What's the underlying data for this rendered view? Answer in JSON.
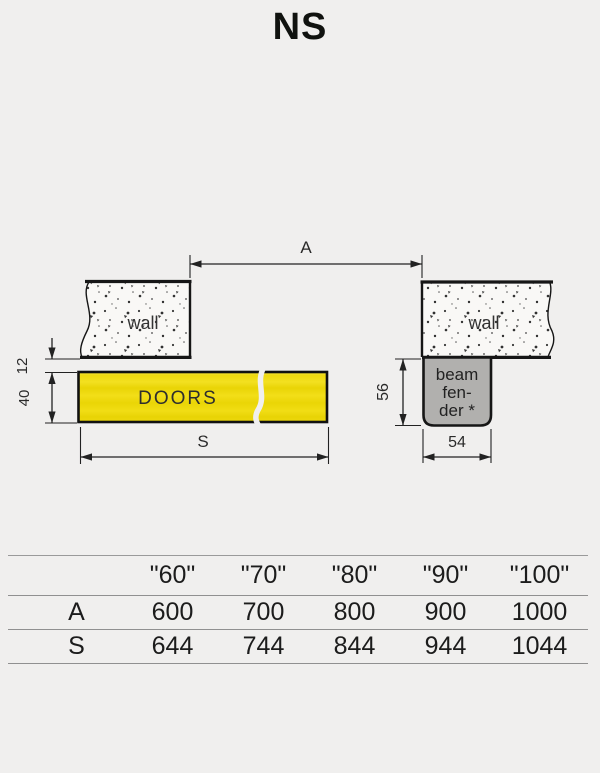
{
  "title": "NS",
  "diagram": {
    "dim_a": "A",
    "dim_s": "S",
    "dim_12": "12",
    "dim_40": "40",
    "dim_56": "56",
    "dim_54": "54",
    "left_wall_label": "wall",
    "right_wall_label": "wall",
    "doors_label": "DOORS",
    "beam_fender": [
      "beam",
      "fen-",
      "der *"
    ],
    "colors": {
      "doors_yellow": "#eed90e",
      "fender_gray": "#b1b0ae",
      "background": "#f0efee",
      "line_dark": "#1a1a1a",
      "table_line_gray": "#909090"
    }
  },
  "table": {
    "col_headers": [
      "\"60\"",
      "\"70\"",
      "\"80\"",
      "\"90\"",
      "\"100\""
    ],
    "rows": [
      {
        "label": "A",
        "values": [
          "600",
          "700",
          "800",
          "900",
          "1000"
        ]
      },
      {
        "label": "S",
        "values": [
          "644",
          "744",
          "844",
          "944",
          "1044"
        ]
      }
    ]
  }
}
